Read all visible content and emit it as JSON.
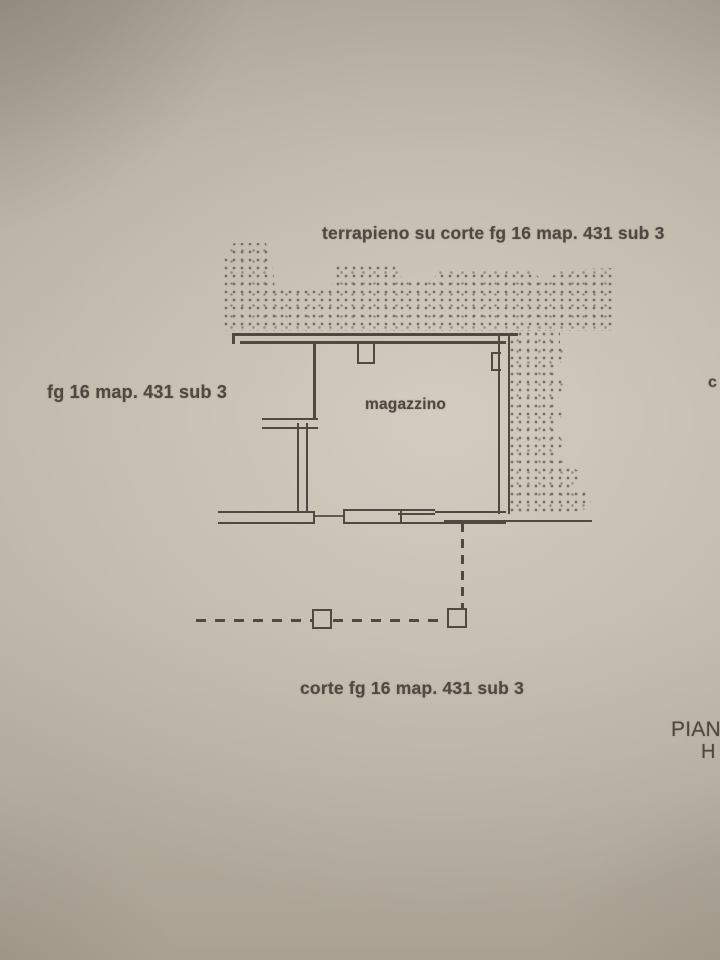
{
  "labels": {
    "top": "terrapieno su corte fg 16 map. 431 sub 3",
    "left": "fg 16 map. 431 sub 3",
    "room": "magazzino",
    "bottom": "corte fg 16 map. 431 sub 3",
    "title_cut": "PIAN",
    "title_line2_cut": "H",
    "right_edge_cut": "c"
  },
  "colors": {
    "ink": "#4e4941",
    "paper_center": "#c9c2b5",
    "paper_edge": "#a59d8f",
    "stipple_dot": "#6e675a"
  }
}
